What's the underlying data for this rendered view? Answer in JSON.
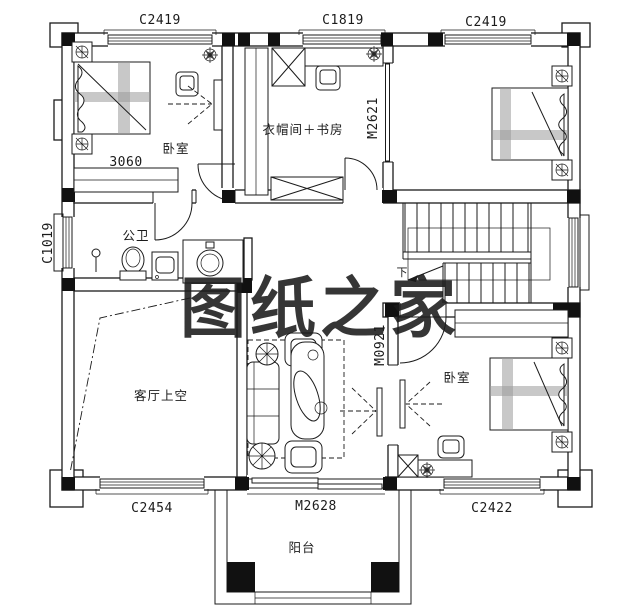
{
  "watermark": {
    "text": "图纸之家",
    "color": "#c5271f"
  },
  "rooms": {
    "bedroom_top_left": "卧室",
    "cloakroom_study": "衣帽间＋书房",
    "public_bathroom": "公卫",
    "living_room_void": "客厅上空",
    "bedroom_bottom_right": "卧室",
    "balcony": "阳台"
  },
  "windows": {
    "top_left": "C2419",
    "top_middle": "C1819",
    "top_right": "C2419",
    "left": "C1019",
    "bottom_left": "C2454",
    "bottom_right": "C2422"
  },
  "doors": {
    "balcony_sliding": "M2628",
    "cloakroom_sliding": "M2621",
    "bedroom_swing": "M0921"
  },
  "dimensions": {
    "wardrobe_width": "3060"
  },
  "stairs": {
    "direction_label": "下"
  },
  "colors": {
    "line": "#1b1b1b",
    "paper": "#ffffff",
    "watermark": "#c5271f"
  }
}
